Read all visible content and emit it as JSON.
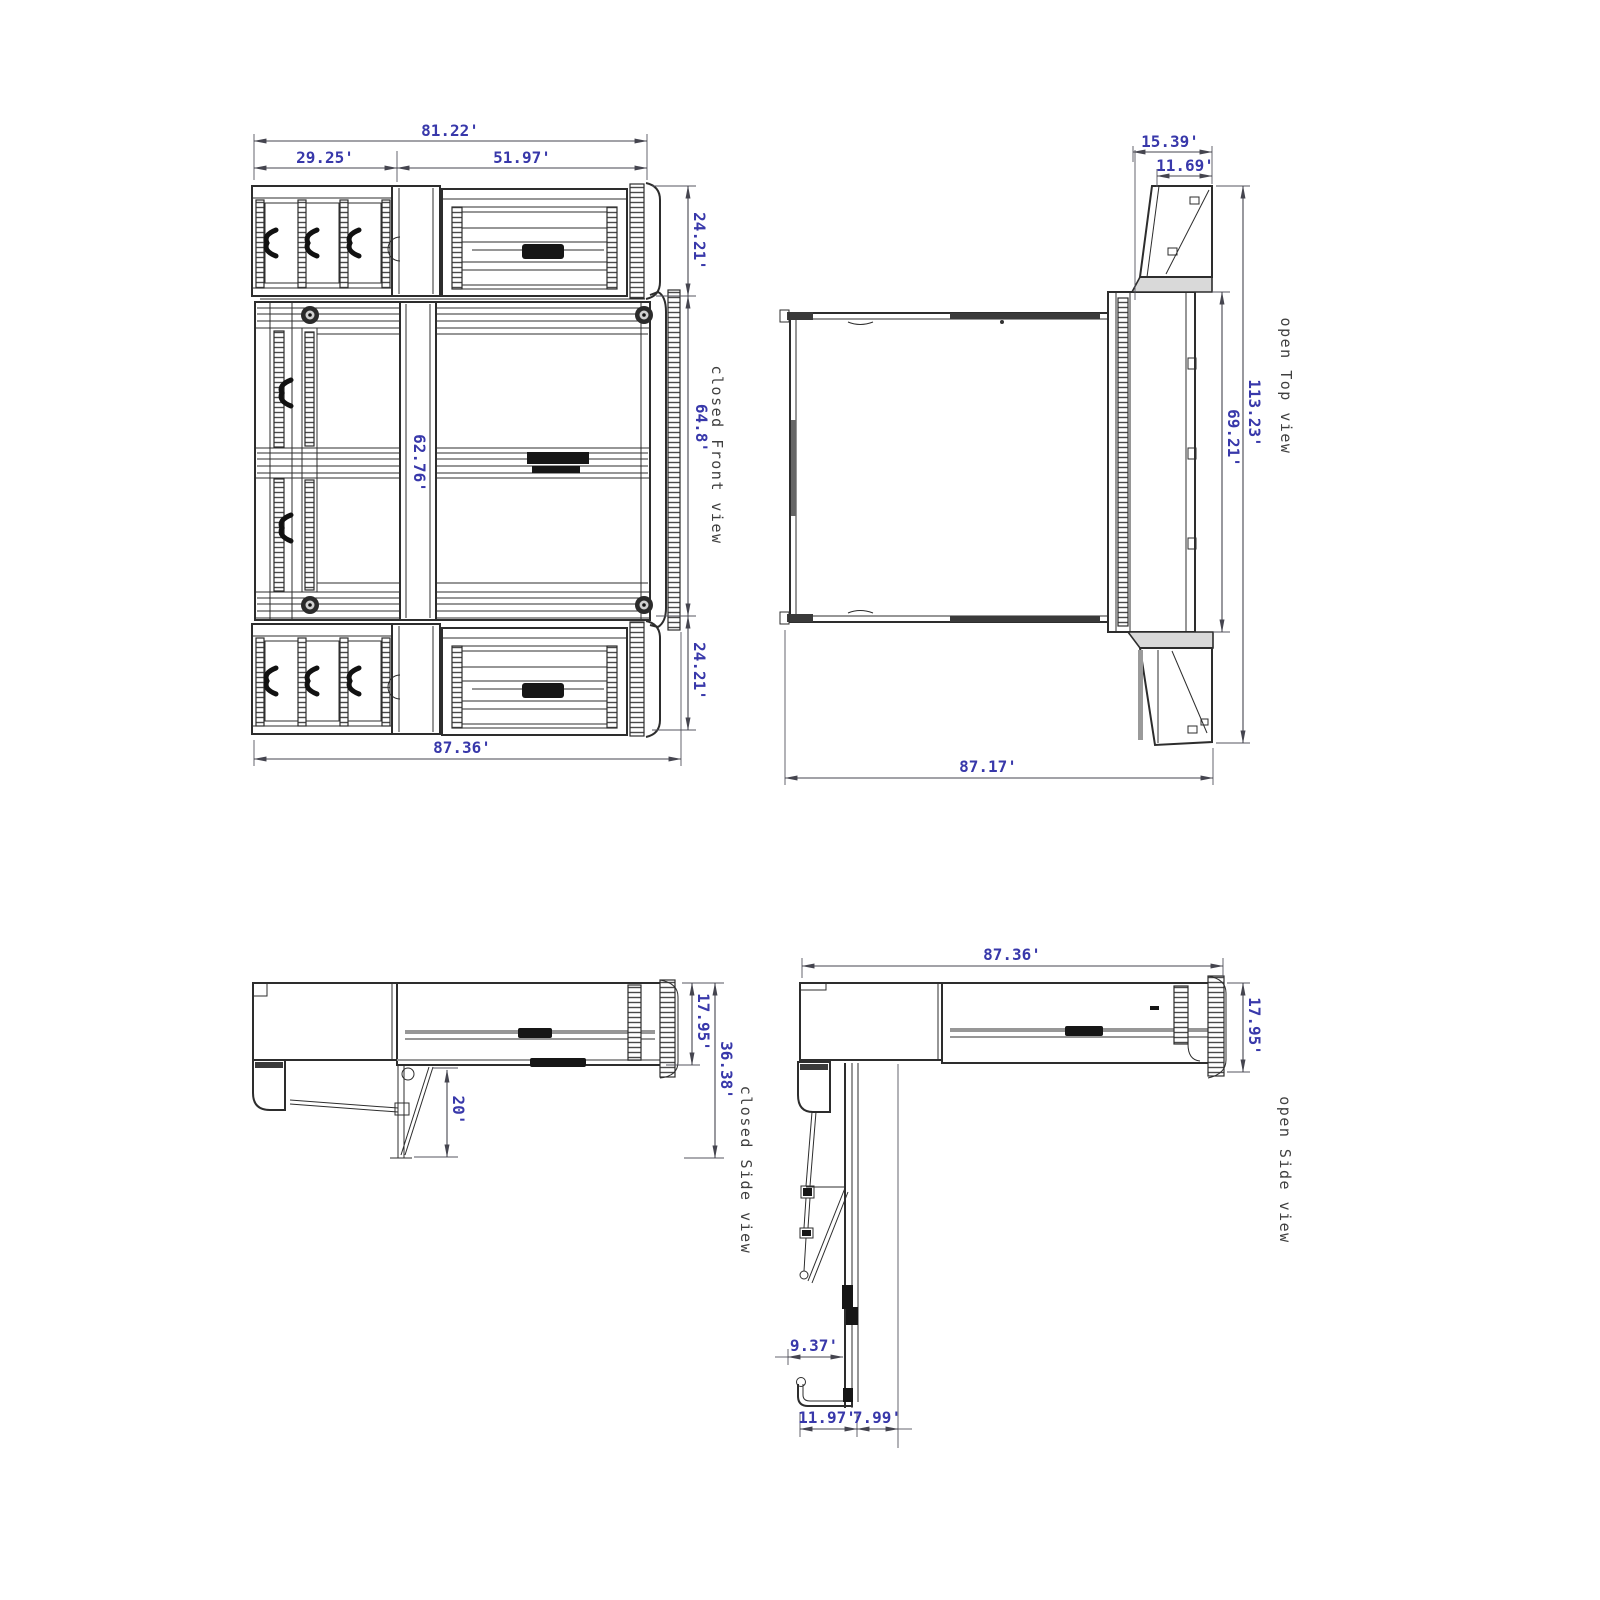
{
  "colors": {
    "background": "#ffffff",
    "drawing_line": "#2d2d2d",
    "dimension_text": "#3838aa",
    "view_label_text": "#3f3f3f"
  },
  "views": {
    "front": {
      "label": "closed Front view",
      "dims": {
        "overall_width": "81.22'",
        "left_section_width": "29.25'",
        "right_section_width": "51.97'",
        "top_section_height": "24.21'",
        "middle_section_height": "64.8'",
        "inner_column_height": "62.76'",
        "bottom_section_height": "24.21'",
        "overall_base_width": "87.36'"
      }
    },
    "top": {
      "label": "open Top view",
      "dims": {
        "door_swing_depth": "15.39'",
        "door_panel_width": "11.69'",
        "overall_depth": "113.23'",
        "bed_opening_depth": "69.21'",
        "overall_width": "87.17'"
      }
    },
    "closed_side": {
      "label": "closed Side view",
      "dims": {
        "cabinet_depth": "17.95'",
        "overall_depth": "36.38'",
        "leg_drop": "20'"
      }
    },
    "open_side": {
      "label": "open Side view",
      "dims": {
        "overall_length": "87.36'",
        "cabinet_depth": "17.95'",
        "foot_offset": "9.37'",
        "foot_length": "11.97'",
        "foot_clearance": "7.99'"
      }
    }
  }
}
